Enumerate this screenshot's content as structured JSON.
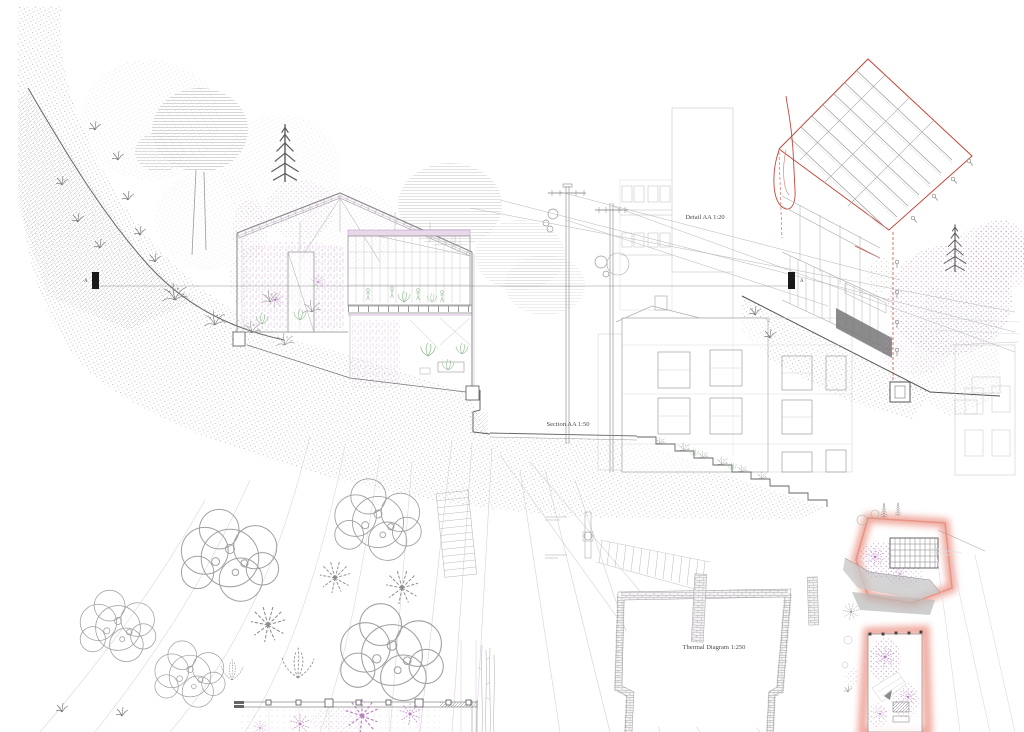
{
  "board": {
    "type": "architectural-presentation-board",
    "drawings": [
      {
        "name": "site-section",
        "label": "Section AA 1:50"
      },
      {
        "name": "construction-detail-axonometric",
        "label": "Detail AA 1:20"
      },
      {
        "name": "thermal-plan-diagrams",
        "label": "Thermal Diagram 1:250"
      }
    ]
  },
  "labels": {
    "detail_aa": "Detail AA 1:20",
    "section_aa": "Section AA 1:50",
    "thermal": "Thermal Diagram 1:250",
    "marker_left": "A",
    "marker_right": "A"
  },
  "colors": {
    "paper": "#ffffff",
    "linework_light": "#c9c9c9",
    "linework_mid": "#8a8a8a",
    "linework_dark": "#3c3c3c",
    "vegetation_pink": "#c49ac9",
    "vegetation_green": "#9bbf9b",
    "detail_red": "#c4463a",
    "thermal_glow": "#e2604e",
    "earth_stipple": "#9a9a9a"
  }
}
